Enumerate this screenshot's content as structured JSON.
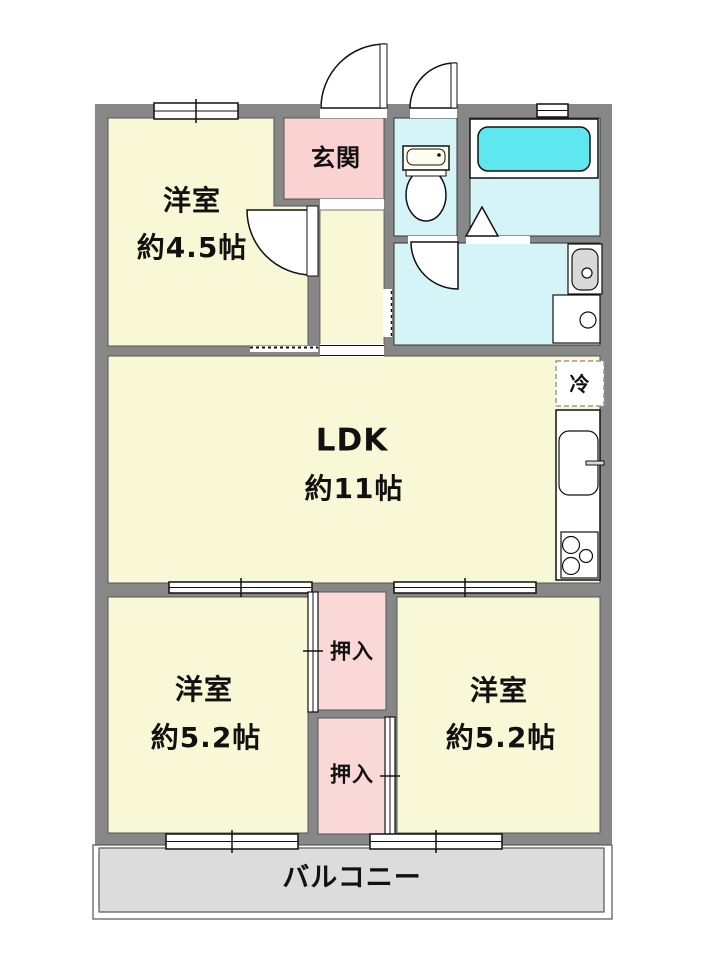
{
  "floorplan": {
    "colors": {
      "wall": "#878787",
      "room": "#f8f7d6",
      "entrance": "#fad2d2",
      "closet": "#fbd8d8",
      "water": "#d4f4f7",
      "bathtub": "#5fe7f0",
      "balcony": "#dcdcdc",
      "fixture_gray": "#d9d9d9",
      "white": "#ffffff"
    },
    "rooms": {
      "western_room_1": {
        "label": "洋室",
        "size": "約4.5帖"
      },
      "entrance": {
        "label": "玄関"
      },
      "ldk": {
        "label": "LDK",
        "size": "約11帖"
      },
      "refrigerator": {
        "label": "冷"
      },
      "western_room_2": {
        "label": "洋室",
        "size": "約5.2帖"
      },
      "western_room_3": {
        "label": "洋室",
        "size": "約5.2帖"
      },
      "closet_1": {
        "label": "押入"
      },
      "closet_2": {
        "label": "押入"
      },
      "balcony": {
        "label": "バルコニー"
      }
    }
  }
}
